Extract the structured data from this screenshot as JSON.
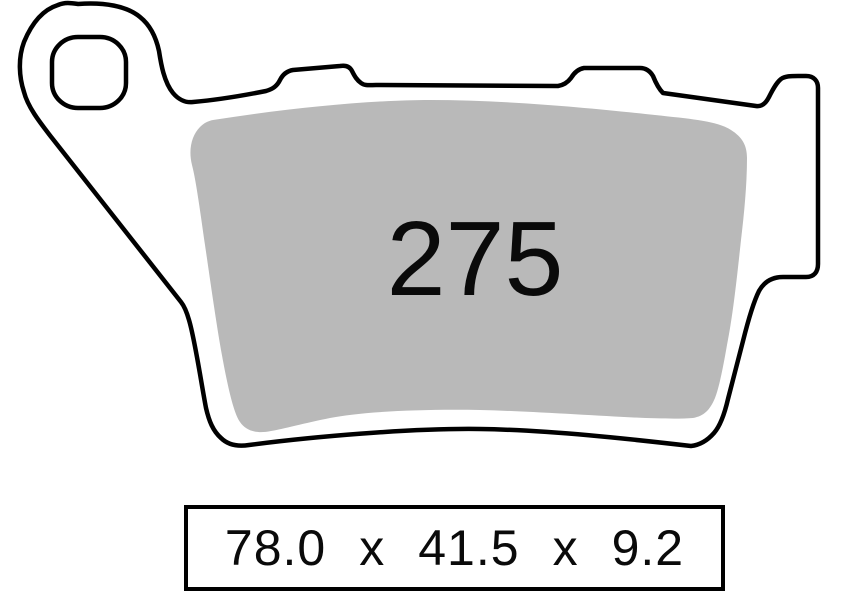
{
  "page": {
    "background_color": "#ffffff"
  },
  "drawing": {
    "kind": "brake-pad-technical-outline",
    "pad_number": "275",
    "pad_fill_color": "#b9b9b9",
    "outline_color": "#000000"
  },
  "dimensions_box": {
    "full_text": "78.0 x 41.5 x 9.2",
    "parts": {
      "width": "78.0",
      "sep1": "x",
      "height": "41.5",
      "sep2": "x",
      "thickness": "9.2"
    }
  }
}
